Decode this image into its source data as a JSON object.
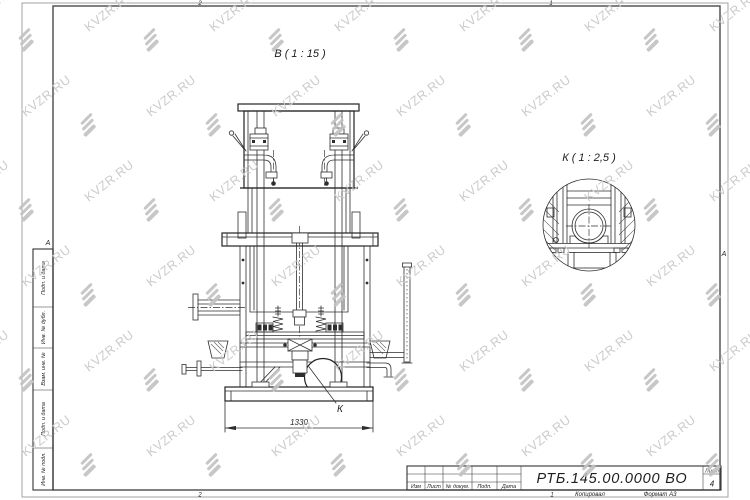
{
  "sheet": {
    "zone_numbers": {
      "top": [
        "2",
        "1"
      ],
      "bottom": [
        "2",
        "1"
      ]
    },
    "fold_marks": {
      "left": "А",
      "right": "А"
    },
    "side_stamp": [
      "Подп. и дата",
      "Инв. № дубл.",
      "Взам. инв. №",
      "Подп. и дата",
      "Инв. № подл."
    ]
  },
  "views": {
    "main": {
      "label": "В ( 1 : 15 )",
      "dimension": "1330",
      "detail_ref": "К"
    },
    "detail": {
      "label": "К ( 1 : 2,5 )"
    }
  },
  "title_block": {
    "columns": [
      "Изм",
      "Лист",
      "№ докум.",
      "Подп.",
      "Дата"
    ],
    "designation": "РТБ.145.00.0000 ВО",
    "sheet_label": "Лист",
    "sheet_number": "4",
    "copied_label": "Копировал",
    "format_label": "Формат А3"
  },
  "watermark": {
    "text": "KVZR.RU",
    "color": "#c9c9c9"
  }
}
